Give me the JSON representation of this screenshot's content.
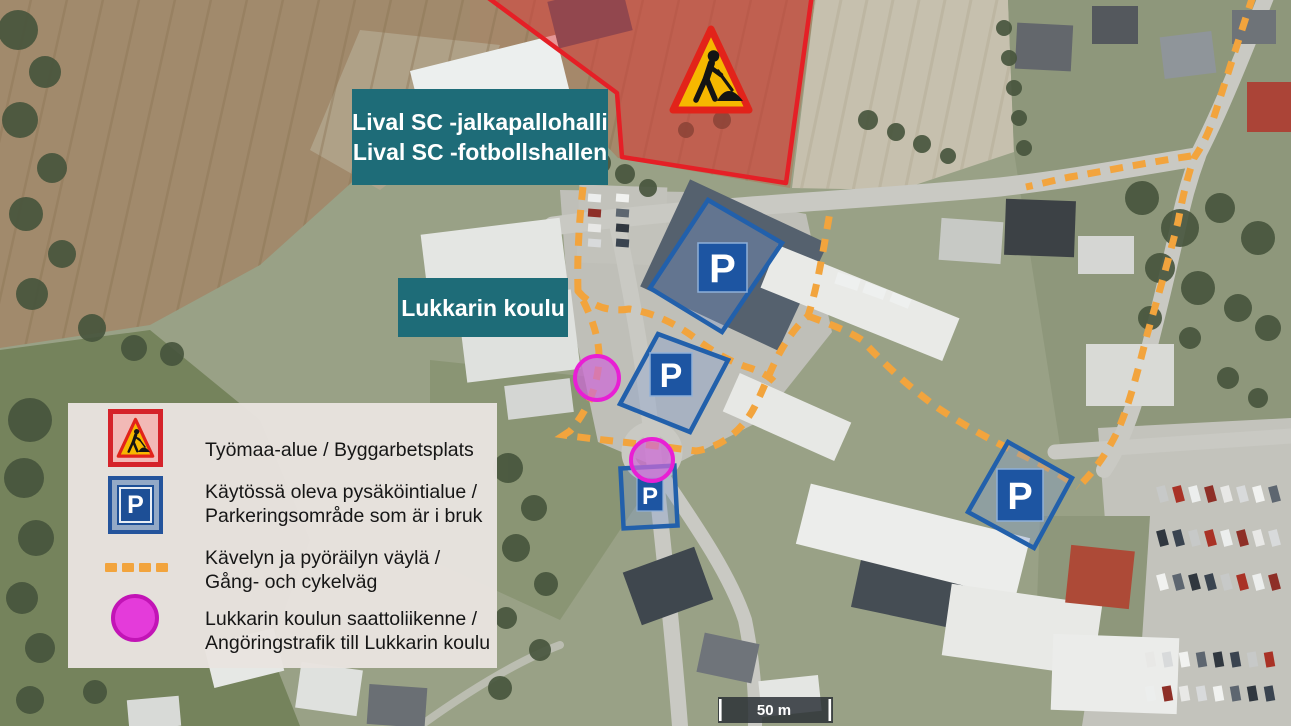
{
  "labels": {
    "hall": {
      "line1": "Lival SC -jalkapallohalli",
      "line2": "Lival SC -fotbollshallen"
    },
    "school": "Lukkarin koulu"
  },
  "map": {
    "parking_symbol": "P",
    "scale_text": "50 m"
  },
  "legend": {
    "items": [
      {
        "icon": "construction-sign-icon",
        "line1": "Työmaa-alue / Byggarbetsplats",
        "line2": ""
      },
      {
        "icon": "parking-sign-icon",
        "line1": "Käytössä oleva pysäköintialue /",
        "line2": "Parkeringsområde som är i bruk"
      },
      {
        "icon": "path-dash-icon",
        "line1": "Kävelyn ja pyöräilyn väylä /",
        "line2": "Gång- och cykelväg"
      },
      {
        "icon": "dropoff-circle-icon",
        "line1": "Lukkarin koulun saattoliikenne /",
        "line2": "Angöringstrafik till Lukkarin koulu"
      }
    ]
  },
  "colors": {
    "construction_red": "#e51f26",
    "path_orange": "#f2a43d",
    "parking_blue": "#1d55a2",
    "dropoff_magenta": "#e81fd4",
    "label_teal": "#1e6c78"
  }
}
